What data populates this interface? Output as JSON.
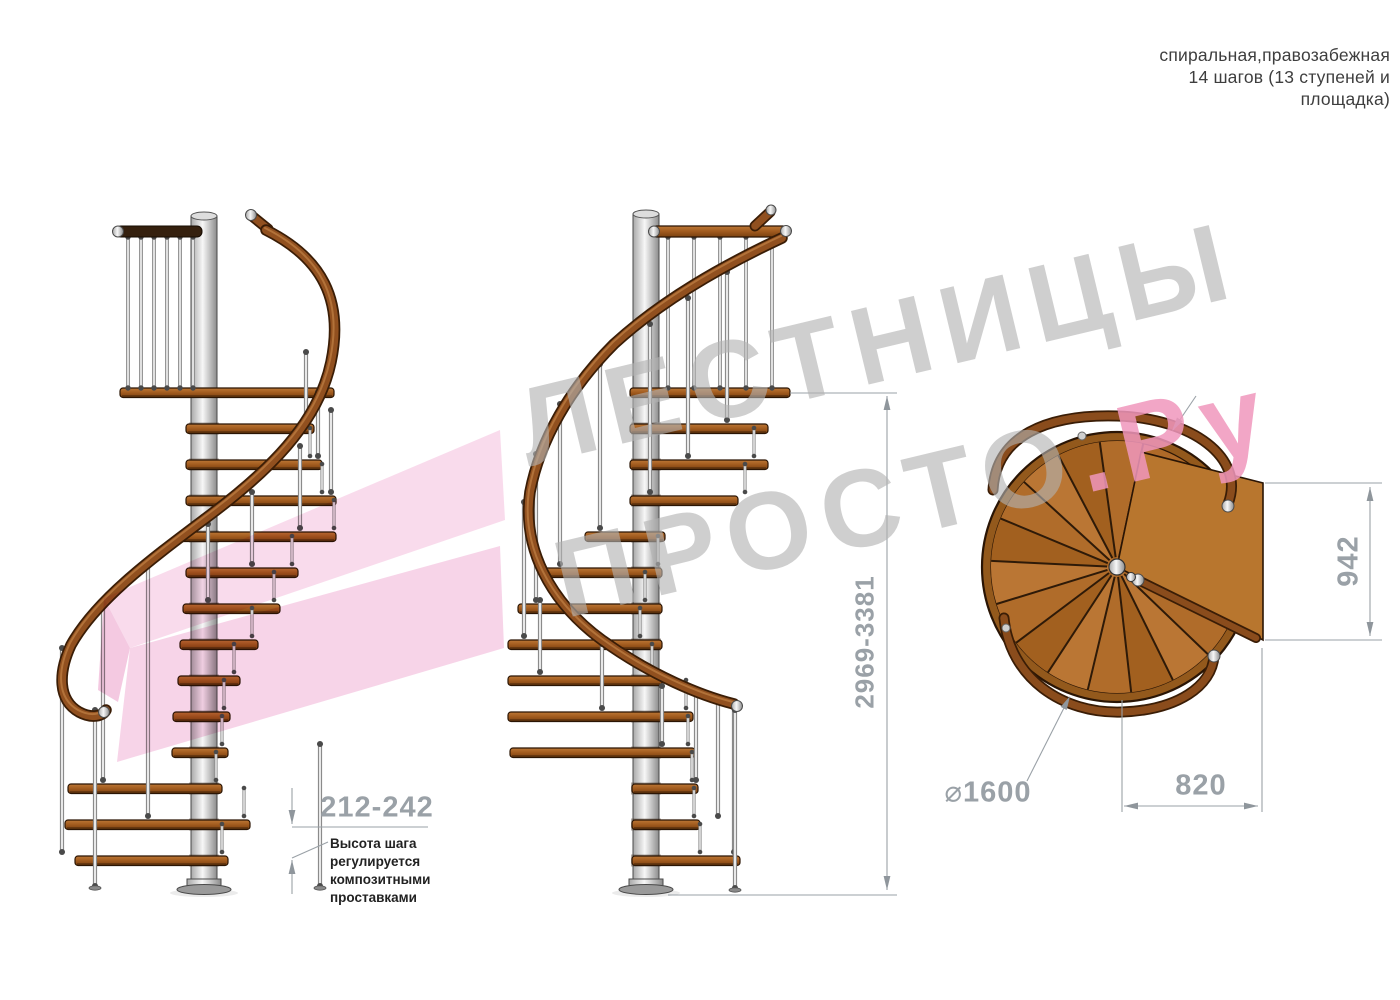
{
  "header": {
    "line1": "спиральная,правозабежная",
    "line2": "14 шагов (13 ступеней и",
    "line3": "площадка)"
  },
  "watermark": {
    "line1": "ЛЕСТНИЦЫ",
    "line2_gray": "ПРОСТО",
    "line2_pink": ".Ру",
    "gray": "#b2b2b2",
    "pink": "#f096bc"
  },
  "annotations": {
    "total_height": {
      "label": "2969-3381"
    },
    "plan_height": {
      "label": "942"
    },
    "plan_width": {
      "label": "820"
    },
    "diameter": {
      "symbol": "⌀",
      "value": "1600"
    },
    "step_height": {
      "label": "212-242",
      "note_lines": [
        "Высота шага",
        "регулируется",
        "композитными",
        "проставками"
      ]
    }
  },
  "colors": {
    "wood": "#a05a1e",
    "rail_wood": "#91501f",
    "dark_rail": "#35200e",
    "metal": "#c9c9c9",
    "dim": "#9aa1a7",
    "watermark_gray": "#b2b2b2",
    "watermark_pink": "#f096bc",
    "ribbon_pink": "#f6cfe5"
  },
  "drawing": {
    "left": {
      "pole": {
        "cx": 204,
        "w": 26,
        "top": 216,
        "bottom": 886
      },
      "platform": [
        120,
        334,
        388
      ],
      "darkRail": {
        "x": 116,
        "y": 226,
        "w": 86,
        "h": 11
      },
      "prailX": [
        128,
        141,
        154,
        167,
        180,
        193
      ],
      "prailTop": 237,
      "prailBot": 388,
      "treads": [
        [
          186,
          314,
          424
        ],
        [
          186,
          322,
          460
        ],
        [
          186,
          336,
          496
        ],
        [
          180,
          336,
          532
        ],
        [
          186,
          298,
          568
        ],
        [
          183,
          280,
          604
        ],
        [
          180,
          258,
          640
        ],
        [
          178,
          240,
          676
        ],
        [
          173,
          230,
          712
        ],
        [
          172,
          228,
          748
        ],
        [
          68,
          222,
          784
        ],
        [
          65,
          250,
          820
        ],
        [
          75,
          228,
          856
        ]
      ],
      "rail": "M 266,230 C 322,258 344,300 331,362 C 318,424 268,472 206,518 C 150,560 96,600 71,645 C 58,673 58,700 79,712 C 92,719 103,716 106,710",
      "railCaps": [
        [
          251,
          215
        ],
        [
          104,
          712
        ]
      ],
      "stub": [
        252,
        216,
        268,
        229
      ],
      "rods": [
        [
          306,
          352,
          420
        ],
        [
          318,
          392,
          456
        ],
        [
          331,
          410,
          492
        ],
        [
          300,
          446,
          528
        ],
        [
          252,
          492,
          564
        ],
        [
          208,
          524,
          600
        ],
        [
          148,
          566,
          816
        ],
        [
          103,
          604,
          780
        ],
        [
          62,
          648,
          852
        ],
        [
          95,
          710,
          886,
          1
        ],
        [
          320,
          744,
          886,
          1
        ]
      ],
      "mini": [
        [
          310,
          428,
          456
        ],
        [
          322,
          464,
          492
        ],
        [
          334,
          500,
          528
        ],
        [
          292,
          536,
          564
        ],
        [
          274,
          572,
          600
        ],
        [
          252,
          608,
          636
        ],
        [
          234,
          644,
          672
        ],
        [
          224,
          680,
          708
        ],
        [
          222,
          716,
          744
        ],
        [
          216,
          752,
          780
        ],
        [
          244,
          788,
          816
        ],
        [
          222,
          824,
          852
        ]
      ]
    },
    "mid": {
      "pole": {
        "cx": 646,
        "w": 26,
        "top": 214,
        "bottom": 886
      },
      "platform": [
        630,
        790,
        388
      ],
      "topRail": {
        "x": 652,
        "y": 226,
        "w": 136,
        "h": 11
      },
      "prailX": [
        668,
        694,
        720,
        746,
        772
      ],
      "prailTop": 237,
      "prailBot": 388,
      "treads": [
        [
          630,
          768,
          424
        ],
        [
          630,
          768,
          460
        ],
        [
          630,
          738,
          496
        ],
        [
          585,
          665,
          532
        ],
        [
          543,
          662,
          568
        ],
        [
          518,
          662,
          604
        ],
        [
          508,
          662,
          640
        ],
        [
          508,
          662,
          676
        ],
        [
          508,
          693,
          712
        ],
        [
          510,
          695,
          748
        ],
        [
          632,
          698,
          784
        ],
        [
          632,
          700,
          820
        ],
        [
          632,
          740,
          856
        ]
      ],
      "rail": "M 782,238 C 722,266 662,300 614,344 C 570,388 540,440 530,492 C 522,548 550,602 602,640 C 652,676 702,696 734,704",
      "railCaps": [
        [
          786,
          231
        ],
        [
          737,
          706
        ]
      ],
      "stub": [
        755,
        226,
        770,
        212
      ],
      "stubCap": [
        771,
        210
      ],
      "rods": [
        [
          727,
          272,
          420
        ],
        [
          688,
          298,
          456
        ],
        [
          650,
          324,
          492
        ],
        [
          600,
          364,
          528
        ],
        [
          560,
          404,
          564
        ],
        [
          536,
          454,
          600
        ],
        [
          524,
          502,
          636
        ],
        [
          540,
          600,
          672
        ],
        [
          602,
          644,
          708
        ],
        [
          662,
          686,
          744
        ],
        [
          696,
          694,
          780
        ],
        [
          718,
          702,
          816
        ],
        [
          734,
          708,
          852
        ],
        [
          735,
          710,
          888,
          1
        ]
      ],
      "mini": [
        [
          754,
          428,
          456
        ],
        [
          745,
          464,
          492
        ],
        [
          658,
          536,
          564
        ],
        [
          645,
          572,
          600
        ],
        [
          640,
          608,
          636
        ],
        [
          652,
          644,
          672
        ],
        [
          686,
          680,
          708
        ],
        [
          688,
          716,
          744
        ],
        [
          692,
          752,
          780
        ],
        [
          694,
          788,
          816
        ],
        [
          700,
          824,
          852
        ]
      ]
    },
    "plan": {
      "cx": 1117,
      "cy": 567,
      "rOuter": 135,
      "rInner": 126,
      "sectorStartDeg": -78,
      "sectorEndDeg": -336,
      "sectors": 13,
      "platform": [
        [
          1117,
          567
        ],
        [
          1141,
          452
        ],
        [
          1263,
          483
        ],
        [
          1263,
          640
        ]
      ],
      "innerRail": [
        1138,
        580,
        1256,
        638
      ],
      "arcs": [
        "M 993,490 C 996,436 1046,414 1117,416 C 1192,418 1246,458 1228,504",
        "M 1004,618 C 1010,678 1062,714 1122,712 C 1178,710 1212,686 1214,656"
      ],
      "caps": [
        [
          1228,
          506
        ],
        [
          1214,
          656
        ],
        [
          1138,
          580
        ]
      ],
      "dots": [
        [
          1082,
          436
        ],
        [
          1006,
          628
        ]
      ],
      "poleR": 8,
      "knob": [
        1131,
        577
      ]
    },
    "dims": {
      "lines": [
        [
          887,
          396,
          887,
          890
        ],
        [
          790,
          393,
          897,
          393
        ],
        [
          668,
          895,
          897,
          895
        ],
        [
          1265,
          483,
          1382,
          483
        ],
        [
          1265,
          640,
          1382,
          640
        ],
        [
          1370,
          487,
          1370,
          636
        ],
        [
          1122,
          700,
          1122,
          812
        ],
        [
          1262,
          648,
          1262,
          812
        ],
        [
          1124,
          806,
          1258,
          806
        ],
        [
          1027,
          781,
          1069,
          698
        ],
        [
          292,
          788,
          292,
          824
        ],
        [
          292,
          894,
          292,
          860
        ],
        [
          292,
          827,
          428,
          827
        ],
        [
          292,
          858,
          328,
          842
        ],
        [
          1196,
          396,
          1173,
          430
        ]
      ],
      "arrows": [
        [
          887,
          396,
          -90
        ],
        [
          887,
          890,
          90
        ],
        [
          1370,
          487,
          -90
        ],
        [
          1370,
          636,
          90
        ],
        [
          1124,
          806,
          180
        ],
        [
          1258,
          806,
          0
        ],
        [
          292,
          824,
          90
        ],
        [
          292,
          860,
          -90
        ],
        [
          1070,
          696,
          -63
        ],
        [
          1172,
          431,
          124
        ]
      ]
    },
    "ribbon": [
      {
        "pts": "500,430 505,520 130,648 104,598",
        "fill": "#f8d7ea"
      },
      {
        "pts": "104,598 130,648 118,702 98,690",
        "fill": "#f3c3de"
      },
      {
        "pts": "130,648 500,546 504,648 117,762",
        "fill": "#f6cfe5"
      }
    ]
  }
}
